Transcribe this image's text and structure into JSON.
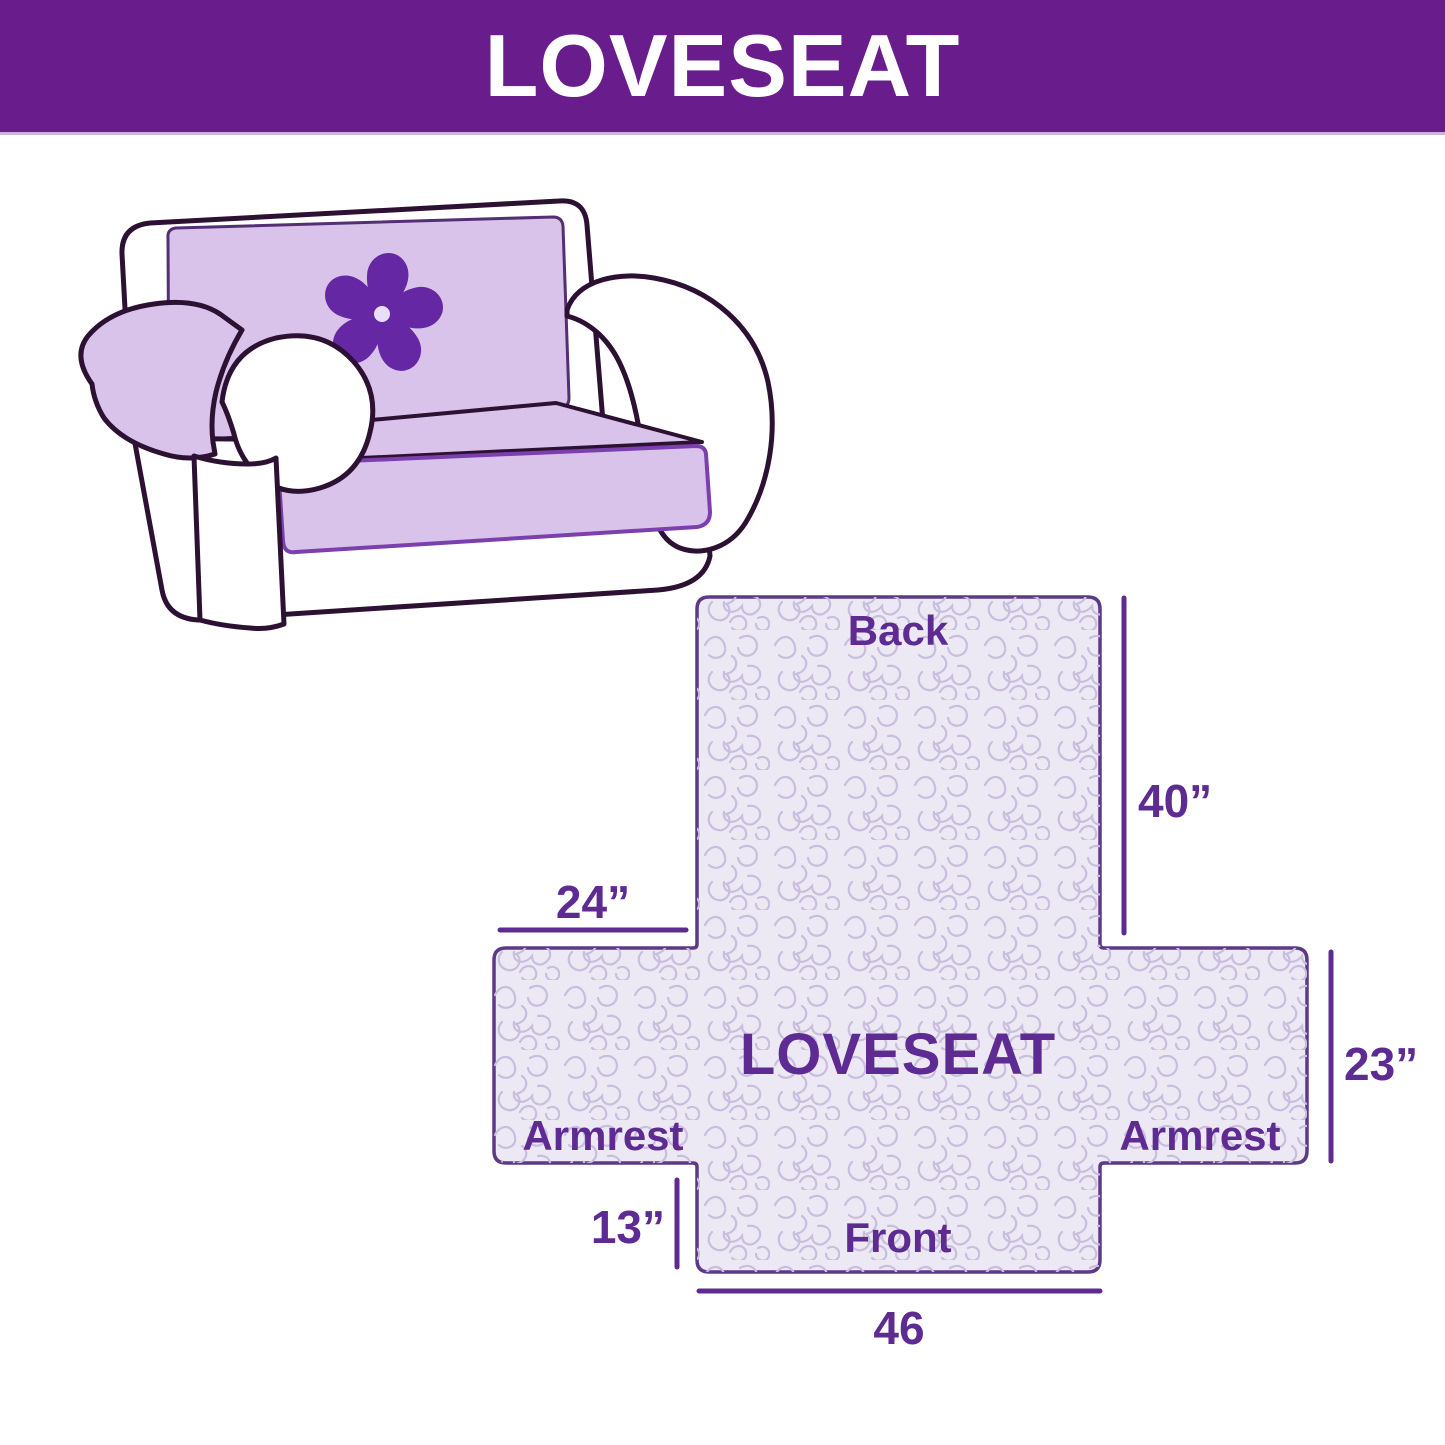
{
  "header": {
    "title": "LOVESEAT"
  },
  "colors": {
    "banner_bg": "#691d8c",
    "banner_text": "#ffffff",
    "accent_purple": "#5e2b92",
    "diagram_fill": "#ece8f4",
    "diagram_border": "#5d3a85",
    "pattern_squiggle": "#c9bedd",
    "couch_cover": "#d9c3ea",
    "couch_outline": "#2d1133",
    "logo_purple": "#6527a3"
  },
  "illustration": {
    "description": "loveseat sofa with quilted protective cover",
    "logo_icon": "pinwheel-flower"
  },
  "diagram": {
    "center_label": "LOVESEAT",
    "back_label": "Back",
    "front_label": "Front",
    "armrest_left_label": "Armrest",
    "armrest_right_label": "Armrest",
    "dim_back_height": "40”",
    "dim_back_width": "24”",
    "dim_seat_depth": "23”",
    "dim_front_height": "13”",
    "dim_front_width": "46"
  }
}
